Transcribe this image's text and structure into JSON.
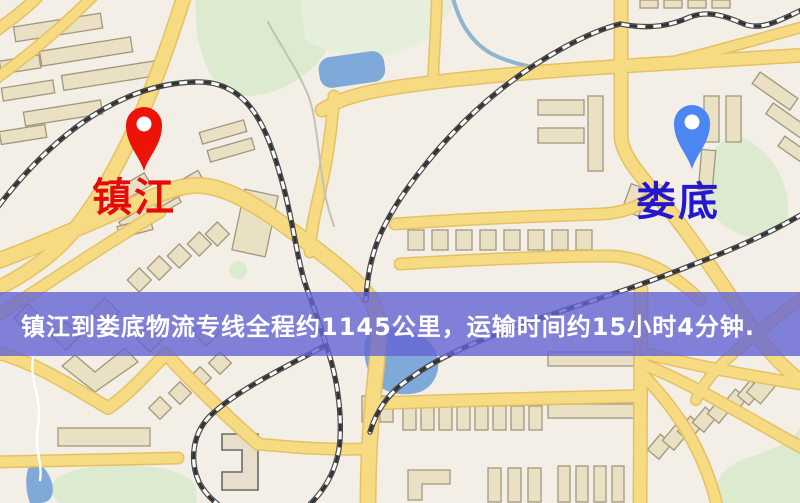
{
  "markers": {
    "origin": {
      "label": "镇江",
      "pin_color": "#ec1309",
      "label_color": "#e60b08"
    },
    "destination": {
      "label": "娄底",
      "pin_color": "#4c86f2",
      "label_color": "#2418cf"
    }
  },
  "banner": {
    "text": "镇江到娄底物流专线全程约1145公里，运输时间约15小时4分钟.",
    "background": "#6464d4",
    "text_color": "#ffffff"
  },
  "map_colors": {
    "background": "#f3efe6",
    "road": "#f6db82",
    "road_casing": "#e5bf5f",
    "railway": "#333333",
    "water": "#7fa9d8",
    "park": "#dcead0",
    "building": "#eae1c4"
  }
}
